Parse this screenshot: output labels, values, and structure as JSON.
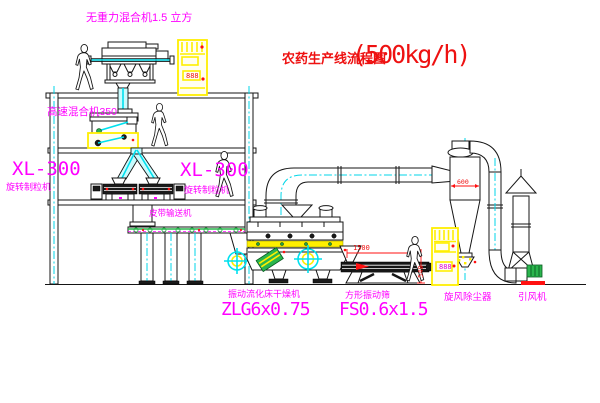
{
  "title": {
    "name": "农药生产线流程图",
    "capacity": "(500kg/h)"
  },
  "equipment_labels": {
    "gravity_mixer": "无重力混合机1.5 立方",
    "high_speed_mixer": "高速混合机350",
    "granulator_left_model": "XL-300",
    "granulator_left_name": "旋转制粒机",
    "granulator_right_model": "XL-300",
    "granulator_right_name": "旋转制粒机",
    "belt_conveyor": "皮带输送机",
    "dryer_name": "振动流化床干燥机",
    "dryer_model": "ZLG6x0.75",
    "screen_name": "方形振动筛",
    "screen_model": "FS0.6x1.5",
    "cyclone": "旋风除尘器",
    "fan": "引风机"
  },
  "dimensions": {
    "screen_length": "1500",
    "screen_height": "540",
    "cyclone_diameter": "600"
  },
  "control_cabinets": [
    {
      "display": "888"
    },
    {
      "display": "888"
    }
  ],
  "colors": {
    "label": "#ff00ff",
    "title": "#ee1111",
    "line": "#151515",
    "cyan": "#00d6e8",
    "yellow": "#ffef00",
    "green": "#2ab54d",
    "red": "#ff1111"
  }
}
